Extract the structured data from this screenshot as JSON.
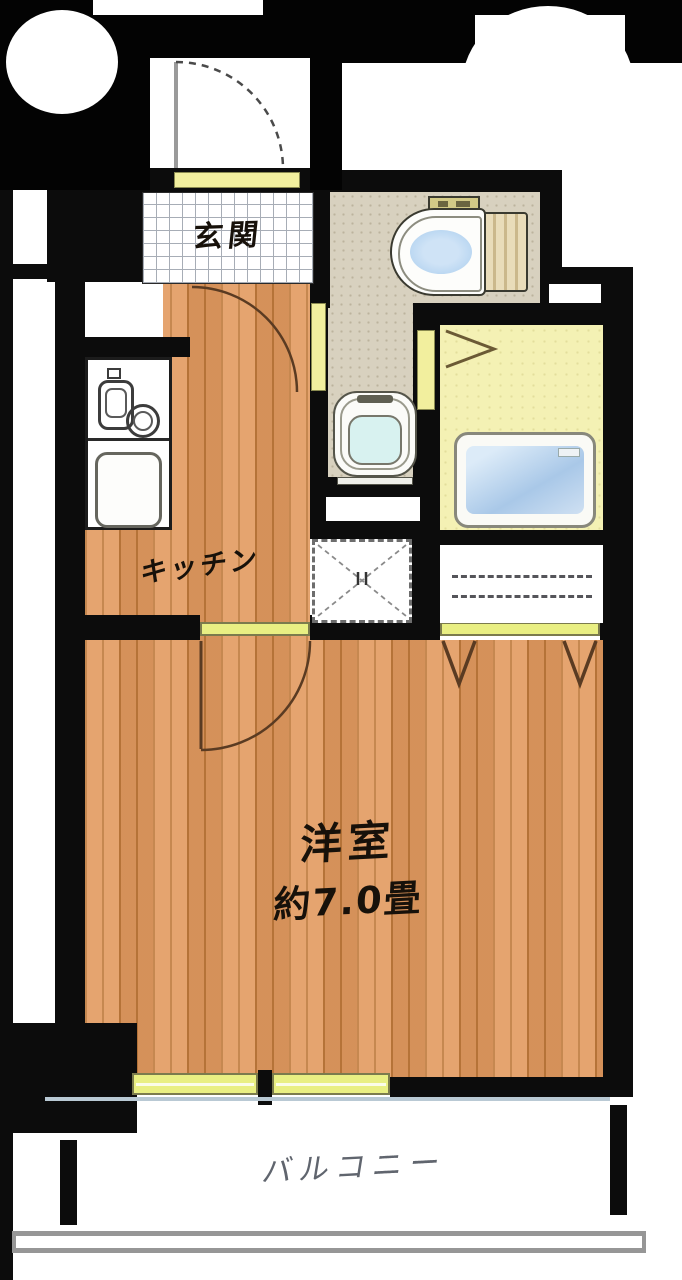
{
  "plan_title": "1K apartment floor plan",
  "rooms": {
    "genkan": {
      "label": "玄関"
    },
    "kitchen": {
      "label": "キッチン"
    },
    "main_room": {
      "name": "洋室",
      "size": "約7.0畳"
    },
    "balcony": {
      "label": "バルコニー"
    }
  },
  "fixtures": [
    "entrance-door-swing",
    "toilet",
    "washbasin",
    "bathtub",
    "kitchen-stove",
    "kitchen-sink",
    "washing-machine-pad",
    "closet-hanger-rods",
    "balcony-window",
    "balcony-railing"
  ],
  "colors": {
    "wall": "#0c0c0c",
    "backdrop": "#030303",
    "wood_floor": "#e29a5f",
    "entrance_tile": "#ffffff",
    "washroom_floor": "#d8d1bf",
    "bathroom_floor": "#f4f1b4",
    "opening_yellow": "#e9ef83",
    "tub_water": "#aecdea",
    "basin_water": "#d8f2f0",
    "railing_gray": "#969696",
    "balcony_text": "#60656e"
  }
}
